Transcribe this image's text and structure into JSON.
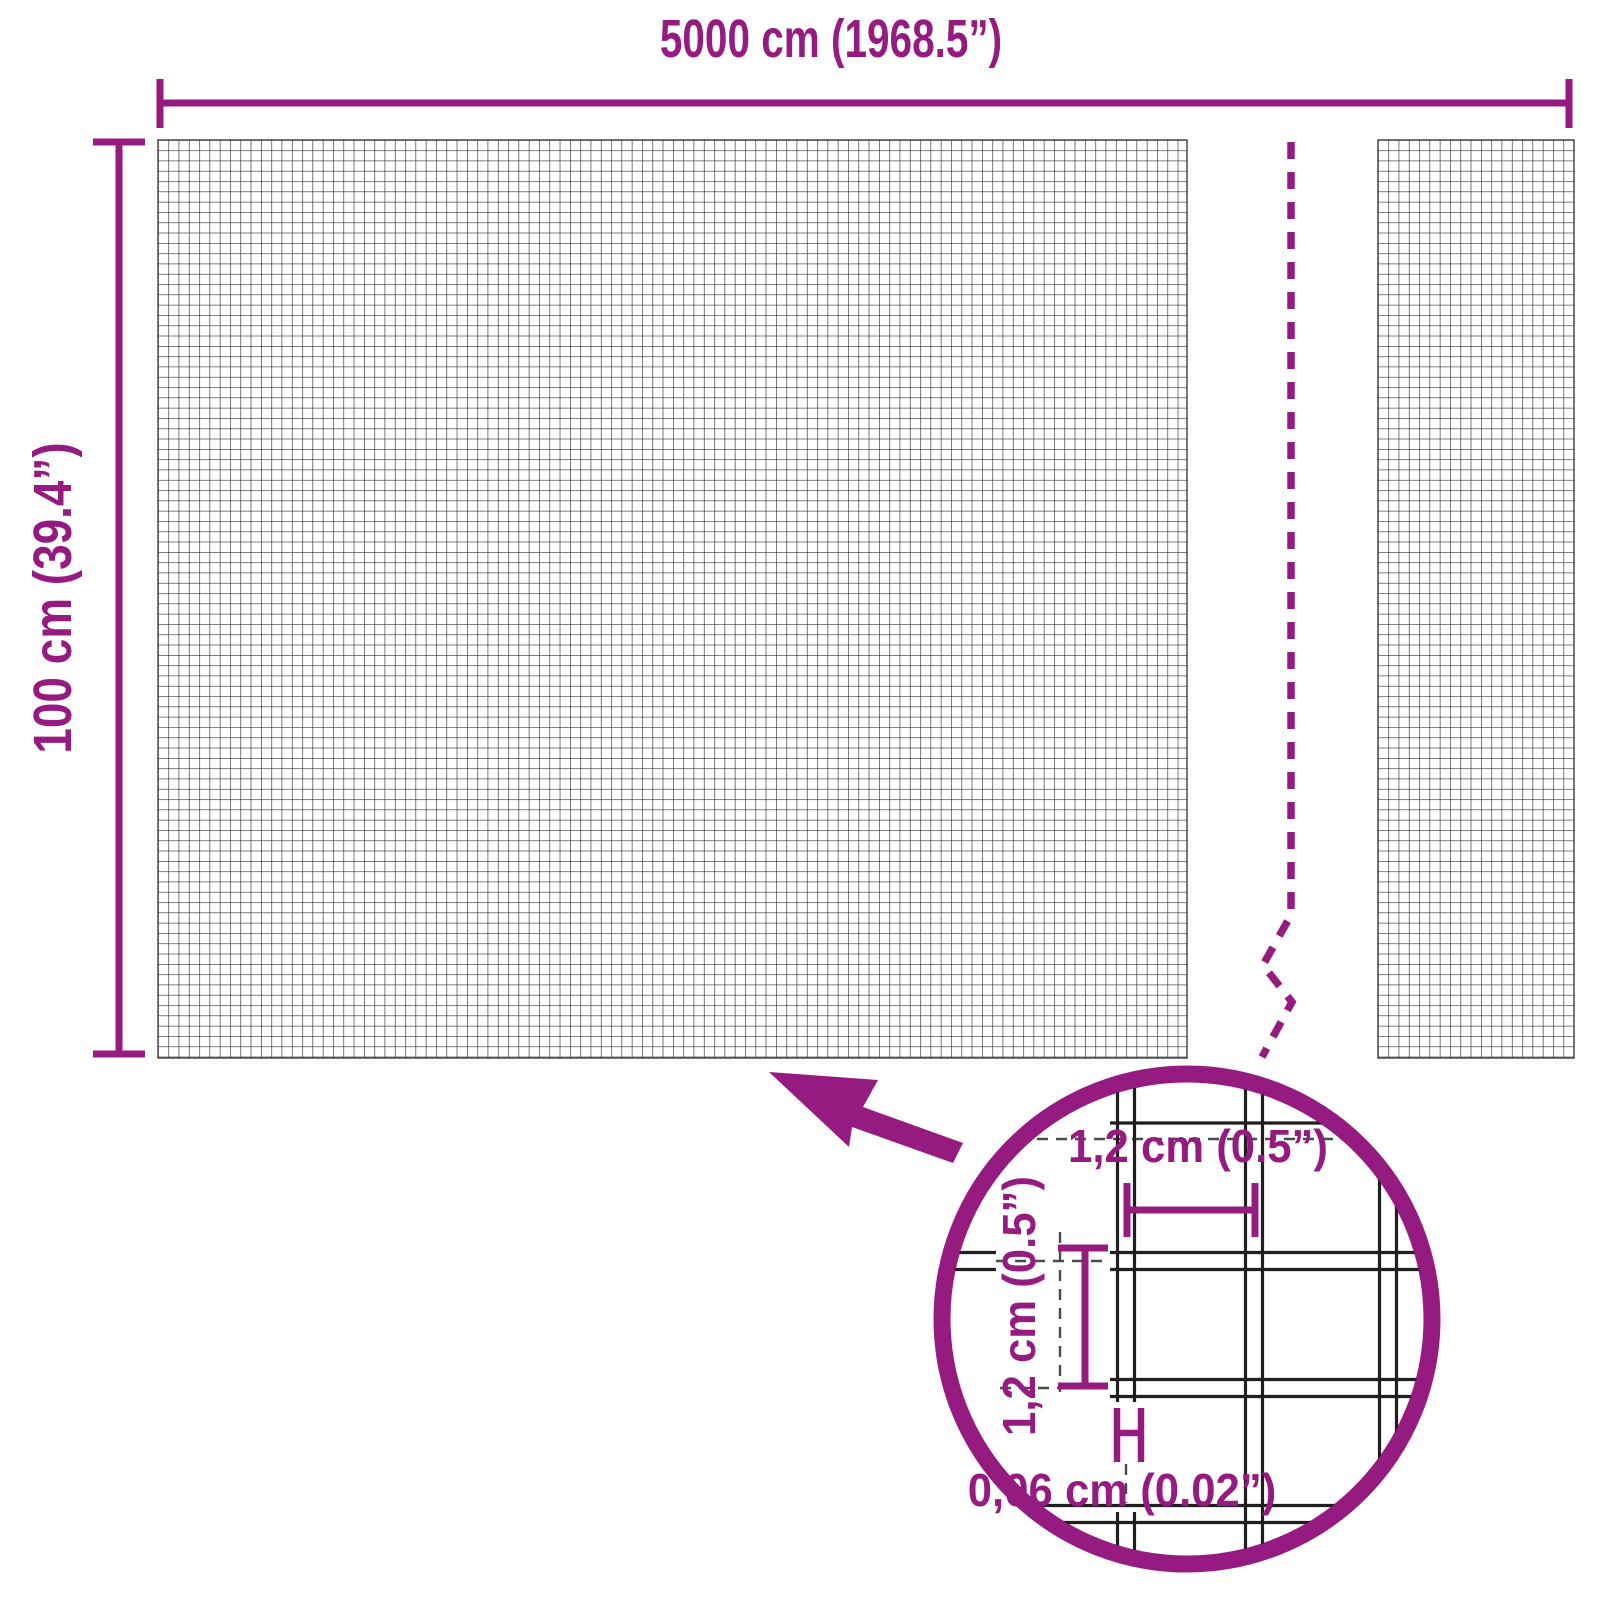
{
  "diagram": {
    "colors": {
      "accent": "#951b80",
      "mesh_line": "#303030",
      "detail_wire": "#1f1f1f",
      "detail_dash": "#4a4a4a",
      "background": "#ffffff"
    },
    "dimensions": {
      "roll_width": "5000 cm (1968.5”)",
      "roll_height": "100 cm (39.4”)",
      "mesh_cell_width": "1,2 cm (0.5”)",
      "mesh_cell_height": "1,2 cm (0.5”)",
      "wire_thickness": "0,06 cm (0.02”)"
    }
  }
}
